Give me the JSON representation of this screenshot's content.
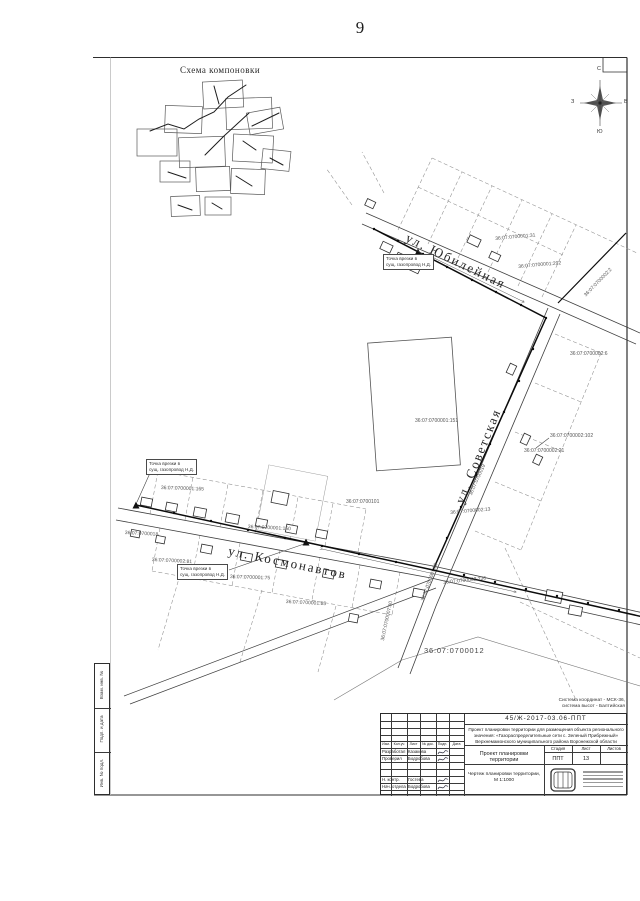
{
  "page": {
    "number": "9"
  },
  "scheme": {
    "title": "Схема компоновки"
  },
  "compass": {
    "north": "С",
    "south": "Ю",
    "west": "З",
    "east": "В"
  },
  "map": {
    "streets": [
      {
        "label": "ул. Юбилейная"
      },
      {
        "label": "ул. Советская"
      },
      {
        "label": "ул. Космонавтов"
      }
    ],
    "callouts": [
      {
        "line1": "Точка врезки в",
        "line2": "сущ. газопровод Н.Д."
      },
      {
        "line1": "Точка врезки в",
        "line2": "сущ. газопровод Н.Д."
      },
      {
        "line1": "Точка врезки в",
        "line2": "сущ. газопровод Н.Д."
      }
    ],
    "parcels": [
      {
        "number": "36:07:0700001:31"
      },
      {
        "number": "36:07:0700001:292"
      },
      {
        "number": "36:07:0700002:6"
      },
      {
        "number": "36:07:0700001:151"
      },
      {
        "number": "36:07:0700002:102"
      },
      {
        "number": "36:07:0700002:21"
      },
      {
        "number": "36:07:0700101"
      },
      {
        "number": "36:07:0700001:165"
      },
      {
        "number": "36:07:0700001:150"
      },
      {
        "number": "36:07:0700018"
      },
      {
        "number": "36:07:0700002:81"
      },
      {
        "number": "36:07:0700001:75"
      },
      {
        "number": "36:07:0700001:85"
      },
      {
        "number": "36:07:0700002:13"
      },
      {
        "number": "36:07:0700002:236"
      },
      {
        "number": "36:07:0700012"
      },
      {
        "number": "36:07:0700019"
      },
      {
        "number": "36:07:0700007:59"
      },
      {
        "number": "36:07:0700007:50"
      },
      {
        "number": "36:07:0700002:2"
      }
    ]
  },
  "notes": {
    "coord_line1": "Система координат - МСК-36,",
    "coord_line2": "система высот - Балтийская"
  },
  "title_block": {
    "doc_number": "45/Ж-2017-03.06-ППТ",
    "description_lines": [
      "Проект планировки территории для размещения объекта регионального",
      "значения: «Газораспределительные сети с. Зеленый Прибрежный»",
      "Верхнемамонского муниципального района Воронежской области"
    ],
    "columns": [
      "Изм.",
      "Кол.уч",
      "Лист",
      "№ док.",
      "Подп.",
      "Дата"
    ],
    "sig_rows": [
      {
        "role": "Разработал",
        "name": "Казакова"
      },
      {
        "role": "Проверил",
        "name": "Бодробова"
      },
      {
        "role": "Н. контр.",
        "name": "Гостева"
      },
      {
        "role": "Нач. отдела",
        "name": "Бодробова"
      }
    ],
    "project_title": "Проект планировки территории",
    "stage_headers": [
      "Стадия",
      "Лист",
      "Листов"
    ],
    "stage": "ППТ",
    "sheet": "13",
    "sheets": "",
    "drawing_title": "Чертеж планировки территории, М 1:1000"
  },
  "side_stamp": {
    "cells": [
      "Взам. инв. №",
      "Подп. и дата",
      "Инв. № подл."
    ]
  }
}
